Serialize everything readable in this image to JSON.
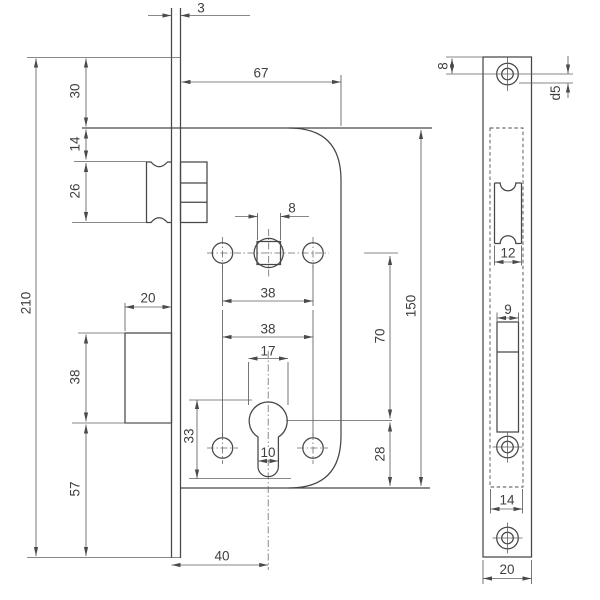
{
  "drawing_title": "Mortise door lock — dimensional drawing",
  "colors": {
    "outline": "#474747",
    "dimension_line": "#5f5f5f",
    "text": "#3f3f3f",
    "background": "#ffffff"
  },
  "front_view": {
    "name": "lock-case-front-view",
    "dims": {
      "faceplate_thickness": "3",
      "body_width": "67",
      "plate_top_to_body": "30",
      "body_top_to_latch": "14",
      "latch_height": "26",
      "plate_height": "210",
      "deadbolt_width": "20",
      "deadbolt_height": "38",
      "deadbolt_to_plate_bottom": "57",
      "spindle_square_size": "8",
      "upper_holes_spacing": "38",
      "lower_holes_spacing": "38",
      "cylinder_diameter": "17",
      "cylinder_profile_height": "33",
      "cylinder_slot_width": "10",
      "backset": "40",
      "body_height": "150",
      "spindle_to_cylinder": "70",
      "cylinder_to_body_bottom": "28"
    }
  },
  "side_view": {
    "name": "faceplate-side-view",
    "dims": {
      "top_hole_offset": "8",
      "screw_hole_diameter": "d5",
      "latch_cutout_width": "12",
      "bolt_cutout_width": "9",
      "case_width": "14",
      "plate_width": "20"
    }
  }
}
